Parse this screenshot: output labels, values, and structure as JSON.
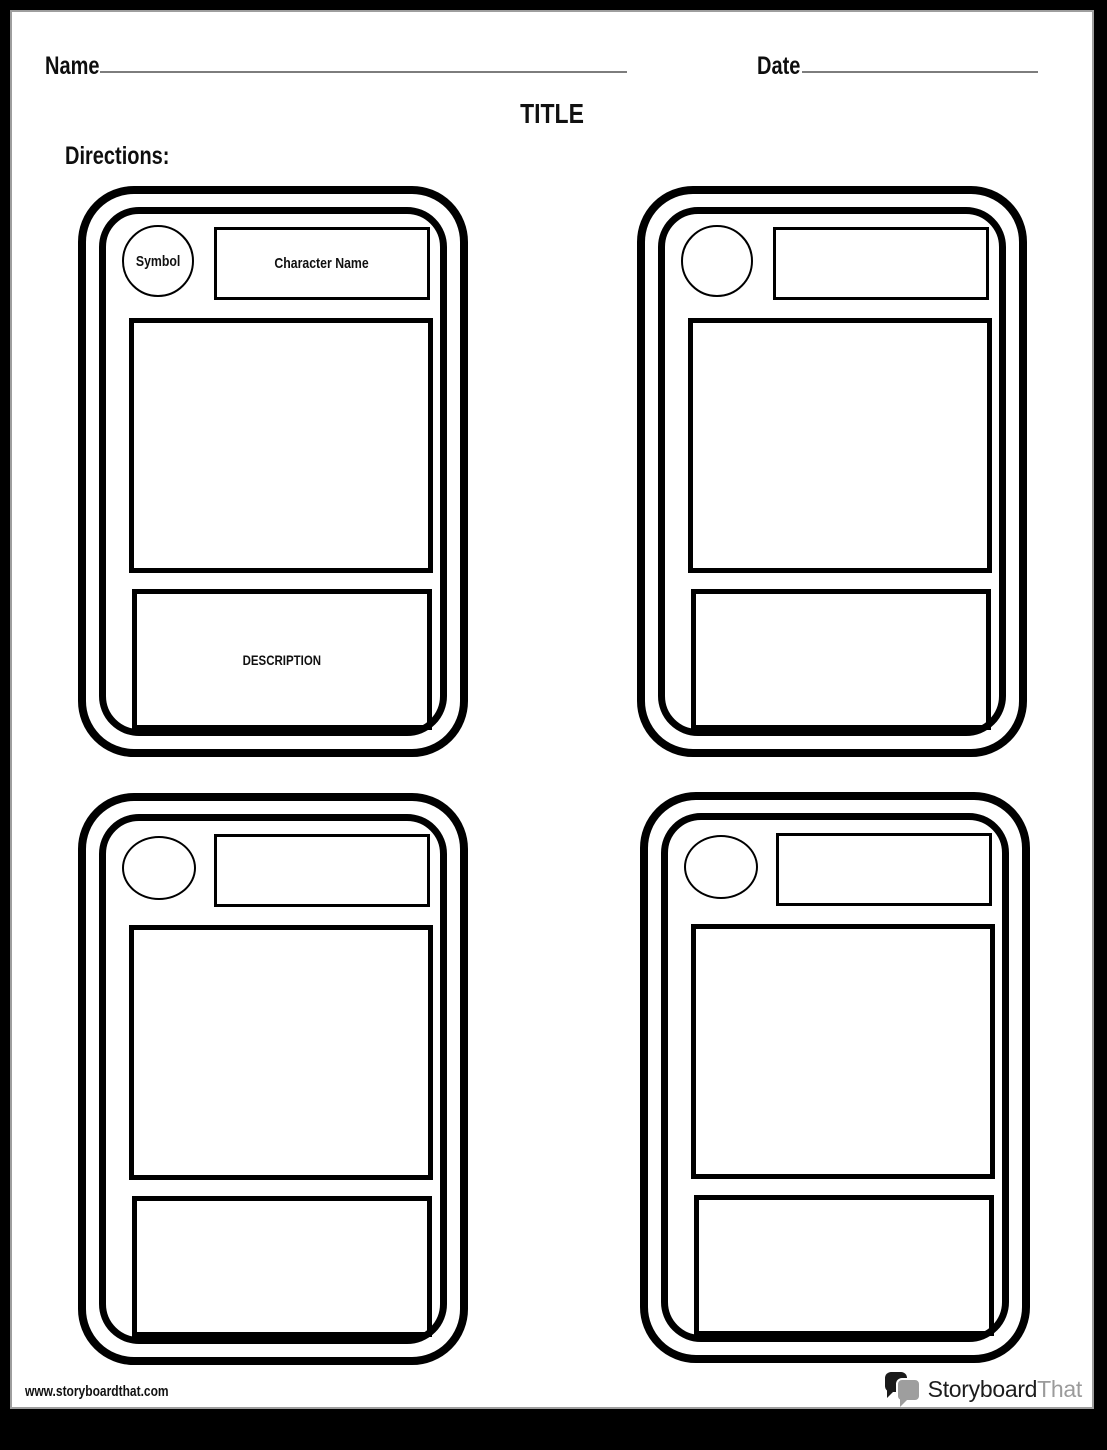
{
  "header": {
    "name_label": "Name",
    "date_label": "Date",
    "title": "TITLE",
    "directions_label": "Directions:"
  },
  "cards": [
    {
      "symbol_label": "Symbol",
      "character_name_label": "Character Name",
      "description_label": "DESCRIPTION"
    },
    {
      "symbol_label": "",
      "character_name_label": "",
      "description_label": ""
    },
    {
      "symbol_label": "",
      "character_name_label": "",
      "description_label": ""
    },
    {
      "symbol_label": "",
      "character_name_label": "",
      "description_label": ""
    }
  ],
  "footer": {
    "url": "www.storyboardthat.com",
    "logo_part1": "Storyboard",
    "logo_part2": "That"
  },
  "colors": {
    "border_black": "#000000",
    "logo_gray": "#9b9b9b",
    "fill_line_gray": "#7d7d7d"
  }
}
